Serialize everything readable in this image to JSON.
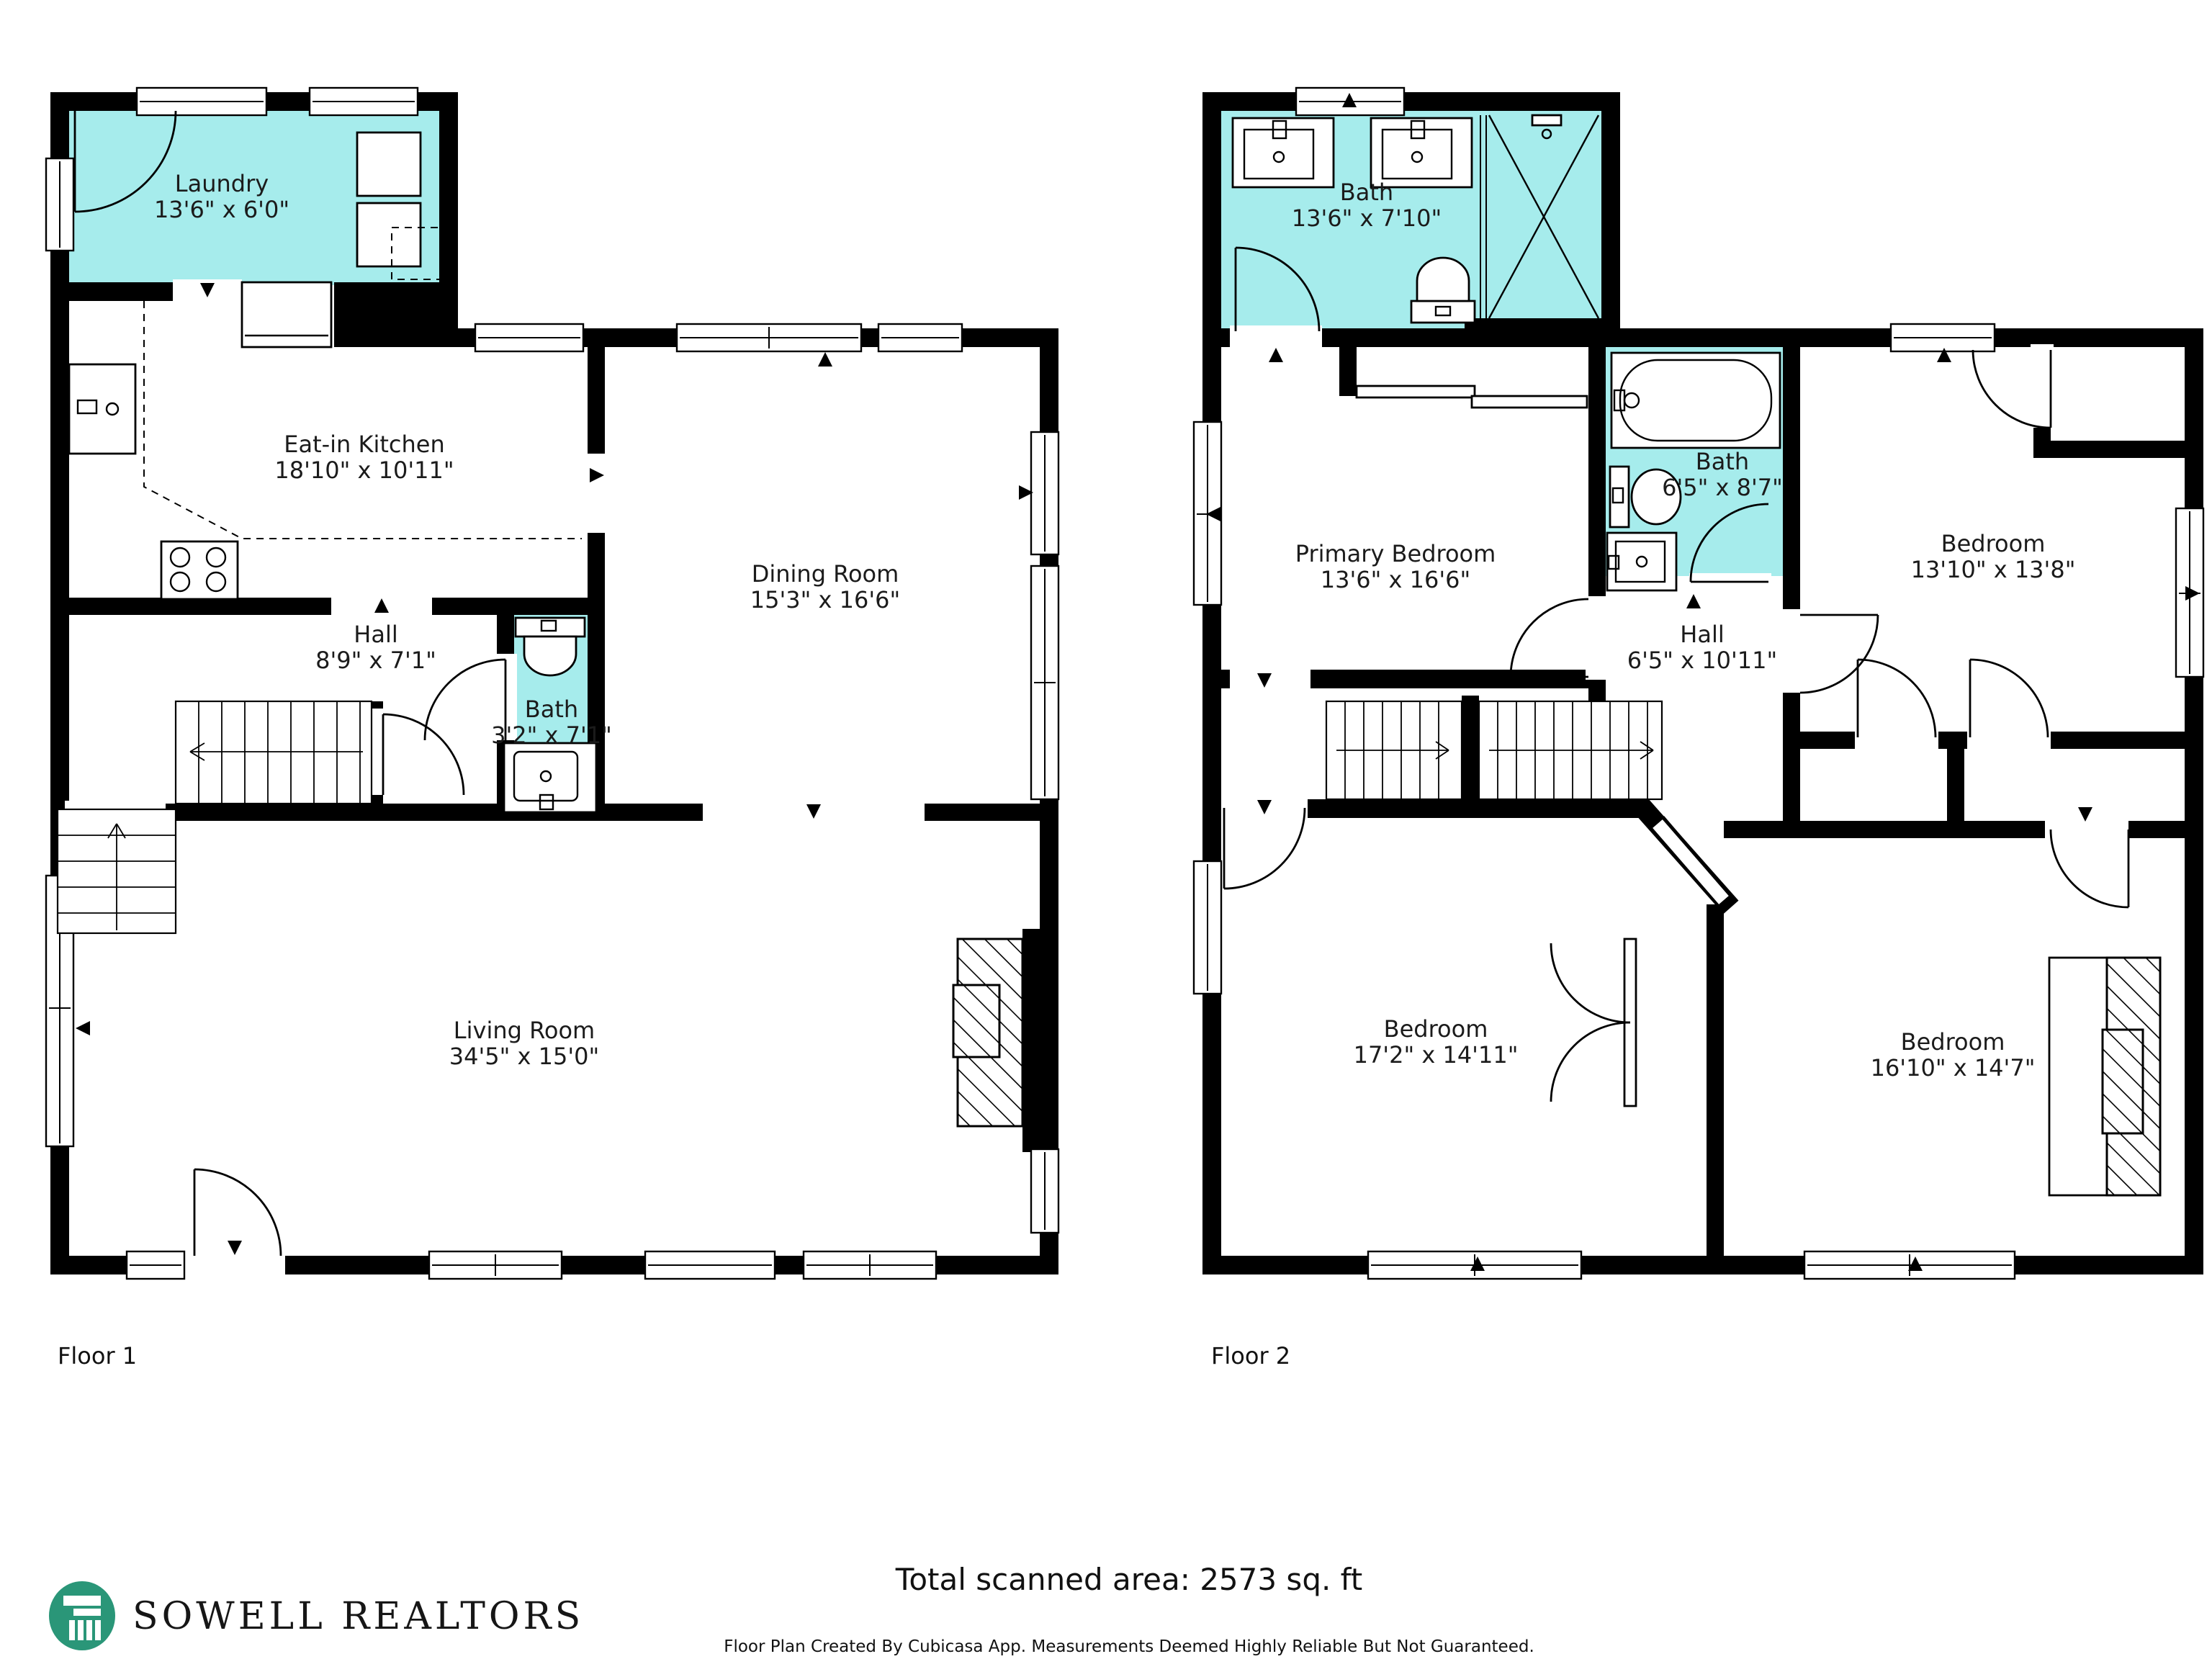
{
  "floor1": {
    "label": "Floor 1",
    "rooms": {
      "laundry": {
        "name": "Laundry",
        "dims": "13'6\" x 6'0\""
      },
      "kitchen": {
        "name": "Eat-in Kitchen",
        "dims": "18'10\" x 10'11\""
      },
      "dining": {
        "name": "Dining Room",
        "dims": "15'3\" x 16'6\""
      },
      "hall": {
        "name": "Hall",
        "dims": "8'9\" x 7'1\""
      },
      "bath": {
        "name": "Bath",
        "dims": "3'2\" x 7'1\""
      },
      "living": {
        "name": "Living Room",
        "dims": "34'5\" x 15'0\""
      }
    }
  },
  "floor2": {
    "label": "Floor 2",
    "rooms": {
      "bath_main": {
        "name": "Bath",
        "dims": "13'6\" x 7'10\""
      },
      "primary": {
        "name": "Primary Bedroom",
        "dims": "13'6\" x 16'6\""
      },
      "bath_small": {
        "name": "Bath",
        "dims": "6'5\" x 8'7\""
      },
      "bedroom_tr": {
        "name": "Bedroom",
        "dims": "13'10\" x 13'8\""
      },
      "hall": {
        "name": "Hall",
        "dims": "6'5\" x 10'11\""
      },
      "bedroom_bl": {
        "name": "Bedroom",
        "dims": "17'2\" x 14'11\""
      },
      "bedroom_br": {
        "name": "Bedroom",
        "dims": "16'10\" x 14'7\""
      }
    }
  },
  "footer": {
    "total_area": "Total scanned area: 2573 sq. ft",
    "disclaimer": "Floor Plan Created By Cubicasa App. Measurements Deemed Highly Reliable But Not Guaranteed.",
    "brand": "SOWELL REALTORS"
  },
  "colors": {
    "wet_room": "#a6ecec",
    "wall": "#000000",
    "brand_green": "#2a9678"
  }
}
